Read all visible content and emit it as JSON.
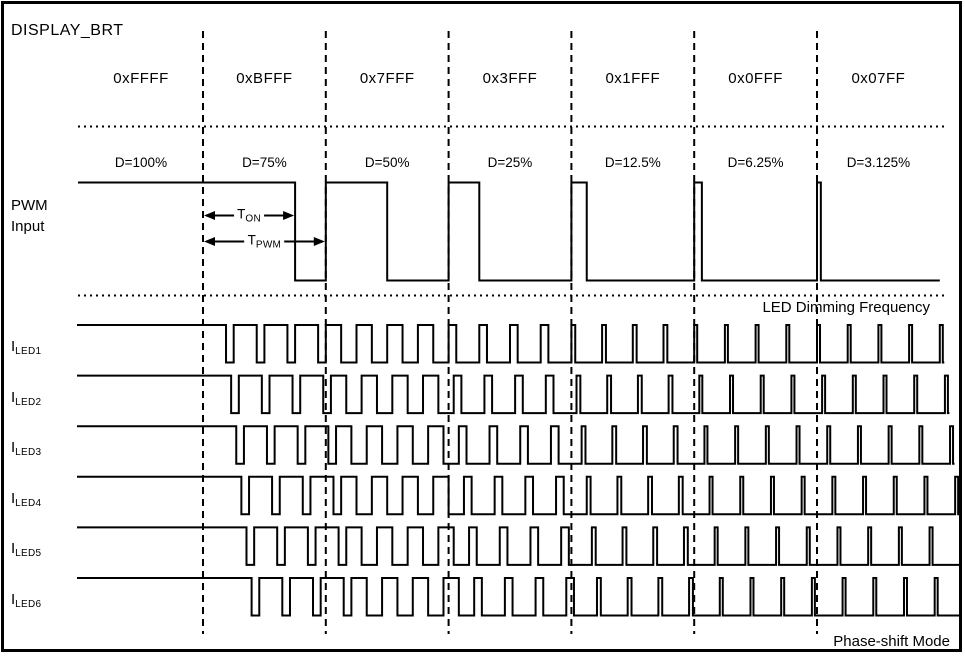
{
  "labels": {
    "pwm_input_line1": "PWM",
    "pwm_input_line2": "Input",
    "t_on": {
      "base": "T",
      "sub": "ON"
    },
    "t_pwm": {
      "base": "T",
      "sub": "PWM"
    },
    "led_dimming_frequency": "LED Dimming Frequency",
    "phase_shift_mode": "Phase-shift Mode"
  },
  "colors": {
    "ink": "#000000",
    "background": "#ffffff"
  },
  "chart_data": {
    "type": "digital-timing",
    "title": "DISPLAY_BRT",
    "description_visible": "PWM input duty per DISPLAY_BRT code with six phase-shifted LED current outputs",
    "columns": [
      {
        "register_code": "0xFFFF",
        "duty_label": "D=100%",
        "duty_fraction": 1.0
      },
      {
        "register_code": "0xBFFF",
        "duty_label": "D=75%",
        "duty_fraction": 0.75
      },
      {
        "register_code": "0x7FFF",
        "duty_label": "D=50%",
        "duty_fraction": 0.5
      },
      {
        "register_code": "0x3FFF",
        "duty_label": "D=25%",
        "duty_fraction": 0.25
      },
      {
        "register_code": "0x1FFF",
        "duty_label": "D=12.5%",
        "duty_fraction": 0.125
      },
      {
        "register_code": "0x0FFF",
        "duty_label": "D=6.25%",
        "duty_fraction": 0.0625
      },
      {
        "register_code": "0x07FF",
        "duty_label": "D=3.125%",
        "duty_fraction": 0.03125
      }
    ],
    "pwm_row": {
      "periods_per_column": 1
    },
    "led_rows": {
      "periods_per_column": 4,
      "phase_step_deg": 60,
      "channels": [
        {
          "label_base": "I",
          "label_sub": "LED1",
          "phase_deg": 0
        },
        {
          "label_base": "I",
          "label_sub": "LED2",
          "phase_deg": 60
        },
        {
          "label_base": "I",
          "label_sub": "LED3",
          "phase_deg": 120
        },
        {
          "label_base": "I",
          "label_sub": "LED4",
          "phase_deg": 180
        },
        {
          "label_base": "I",
          "label_sub": "LED5",
          "phase_deg": 240
        },
        {
          "label_base": "I",
          "label_sub": "LED6",
          "phase_deg": 300
        }
      ]
    },
    "annotations": {
      "t_on": "TON",
      "t_pwm": "TPWM",
      "led_dimming_frequency": "LED Dimming Frequency",
      "phase_shift_mode": "Phase-shift Mode"
    }
  }
}
